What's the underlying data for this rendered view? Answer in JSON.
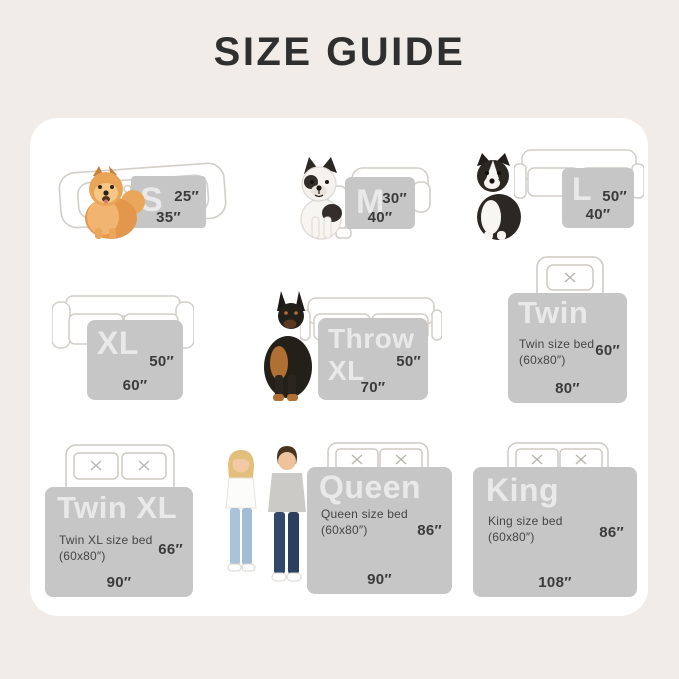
{
  "title": "SIZE GUIDE",
  "colors": {
    "background": "#f1ece7",
    "card": "#ffffff",
    "blanket": "#c6c6c6",
    "blanket_label": "rgba(255,255,255,0.62)",
    "dimension_text": "#3b3b3b",
    "title_text": "#2f2f2f",
    "outline": "#d2cec9"
  },
  "sizes": [
    {
      "label": "S",
      "side": "25″",
      "bottom": "35″",
      "illustration": "pomeranian dog on pet bed"
    },
    {
      "label": "M",
      "side": "30″",
      "bottom": "40″",
      "illustration": "french bulldog beside armchair"
    },
    {
      "label": "L",
      "side": "50″",
      "bottom": "40″",
      "illustration": "border collie beside sofa"
    },
    {
      "label": "XL",
      "side": "50″",
      "bottom": "60″",
      "illustration": "sofa"
    },
    {
      "label": "Throw XL",
      "side": "50″",
      "bottom": "70″",
      "illustration": "doberman beside sofa"
    },
    {
      "label": "Twin",
      "subtitle": "Twin size bed",
      "dimensions": "(60x80″)",
      "side": "60″",
      "bottom": "80″",
      "illustration": "bed with one pillow"
    },
    {
      "label": "Twin XL",
      "subtitle": "Twin XL size bed",
      "dimensions": "(60x80″)",
      "side": "66″",
      "bottom": "90″",
      "illustration": "bed with two pillows"
    },
    {
      "label": "Queen",
      "subtitle": "Queen size bed",
      "dimensions": "(60x80″)",
      "side": "86″",
      "bottom": "90″",
      "illustration": "couple standing beside bed"
    },
    {
      "label": "King",
      "subtitle": "King size bed",
      "dimensions": "(60x80″)",
      "side": "86″",
      "bottom": "108″",
      "illustration": "bed with two pillows"
    }
  ]
}
